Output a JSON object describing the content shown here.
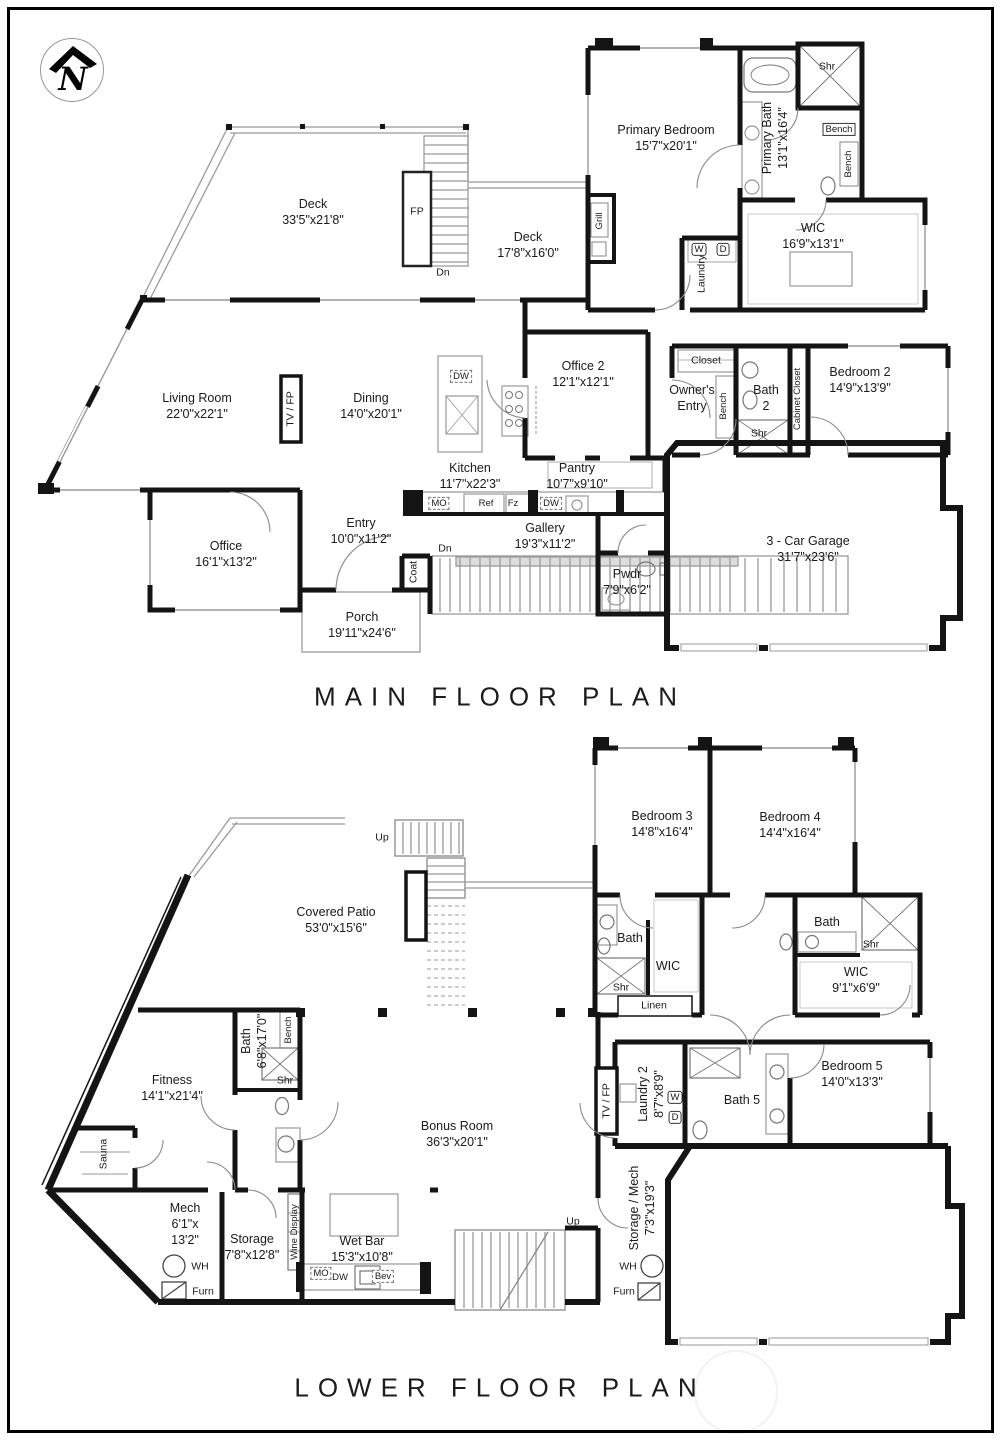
{
  "logo": {
    "name": "north-arrow-monogram",
    "letter": "N"
  },
  "main_floor": {
    "title": "MAIN FLOOR PLAN",
    "rooms": {
      "deck1": {
        "name": "Deck",
        "dims": "33'5\"x21'8\""
      },
      "deck2": {
        "name": "Deck",
        "dims": "17'8\"x16'0\""
      },
      "primary_bedroom": {
        "name": "Primary Bedroom",
        "dims": "15'7\"x20'1\""
      },
      "primary_bath": {
        "name": "Primary Bath",
        "dims": "13'1\"x16'4\""
      },
      "wic": {
        "name": "WIC",
        "dims": "16'9\"x13'1\""
      },
      "bedroom2": {
        "name": "Bedroom 2",
        "dims": "14'9\"x13'9\""
      },
      "living": {
        "name": "Living Room",
        "dims": "22'0\"x22'1\""
      },
      "dining": {
        "name": "Dining",
        "dims": "14'0\"x20'1\""
      },
      "kitchen": {
        "name": "Kitchen",
        "dims": "11'7\"x22'3\""
      },
      "pantry": {
        "name": "Pantry",
        "dims": "10'7\"x9'10\""
      },
      "office2": {
        "name": "Office 2",
        "dims": "12'1\"x12'1\""
      },
      "office": {
        "name": "Office",
        "dims": "16'1\"x13'2\""
      },
      "entry": {
        "name": "Entry",
        "dims": "10'0\"x11'2\""
      },
      "gallery": {
        "name": "Gallery",
        "dims": "19'3\"x11'2\""
      },
      "porch": {
        "name": "Porch",
        "dims": "19'11\"x24'6\""
      },
      "pwdr": {
        "name": "Pwdr",
        "dims": "7'9\"x6'2\""
      },
      "garage": {
        "name": "3 - Car Garage",
        "dims": "31'7\"x23'6\""
      },
      "owners_entry": {
        "name": "Owner's Entry"
      },
      "bath2": {
        "name": "Bath 2"
      },
      "closet": {
        "name": "Closet"
      },
      "laundry": {
        "name": "Laundry"
      }
    },
    "fixtures": {
      "fp": "FP",
      "dn_deck": "Dn",
      "dn_gallery": "Dn",
      "tv_fp": "TV / FP",
      "grill": "Grill",
      "shr_primary": "Shr",
      "bench_a": "Bench",
      "bench_b": "Bench",
      "washer": "W",
      "dryer": "D",
      "bench_c": "Bench",
      "shr_bath2": "Shr",
      "cabinet_closet": "Cabinet Closet",
      "coat": "Coat",
      "mo": "MO",
      "ref": "Ref",
      "fz": "Fz",
      "dw_island": "DW",
      "dw_counter": "DW"
    }
  },
  "lower_floor": {
    "title": "LOWER FLOOR PLAN",
    "rooms": {
      "bedroom3": {
        "name": "Bedroom 3",
        "dims": "14'8\"x16'4\""
      },
      "bedroom4": {
        "name": "Bedroom 4",
        "dims": "14'4\"x16'4\""
      },
      "covered_patio": {
        "name": "Covered Patio",
        "dims": "53'0\"x15'6\""
      },
      "bath3": {
        "name": "Bath"
      },
      "wic3": {
        "name": "WIC"
      },
      "linen": {
        "name": "Linen"
      },
      "bath4": {
        "name": "Bath"
      },
      "wic4": {
        "name": "WIC",
        "dims": "9'1\"x6'9\""
      },
      "bedroom5": {
        "name": "Bedroom 5",
        "dims": "14'0\"x13'3\""
      },
      "bath5": {
        "name": "Bath 5"
      },
      "laundry2": {
        "name": "Laundry 2",
        "dims": "8'7\"x8'9\""
      },
      "bonus": {
        "name": "Bonus Room",
        "dims": "36'3\"x20'1\""
      },
      "fitness": {
        "name": "Fitness",
        "dims": "14'1\"x21'4\""
      },
      "bath_fitness": {
        "name": "Bath",
        "dims": "6'8\"x17'0\""
      },
      "sauna": {
        "name": "Sauna"
      },
      "mech": {
        "name": "Mech",
        "dims_line1": "6'1\"x",
        "dims_line2": "13'2\""
      },
      "storage": {
        "name": "Storage",
        "dims": "7'8\"x12'8\""
      },
      "wet_bar": {
        "name": "Wet Bar",
        "dims": "15'3\"x10'8\""
      },
      "storage_mech": {
        "name": "Storage / Mech",
        "dims": "7'3\"x19'3\""
      }
    },
    "fixtures": {
      "up_stairs": "Up",
      "up_stairs2": "Up",
      "shr_bath3": "Shr",
      "shr_bath4": "Shr",
      "shr_fitness": "Shr",
      "bench_fitness": "Bench",
      "tv_fp": "TV / FP",
      "washer": "W",
      "dryer": "D",
      "wine_display": "Wine Display",
      "mo": "MO",
      "dw": "DW",
      "bev": "Bev",
      "wh_mech": "WH",
      "furn_mech": "Furn",
      "wh_storage": "WH",
      "furn_storage": "Furn"
    }
  }
}
